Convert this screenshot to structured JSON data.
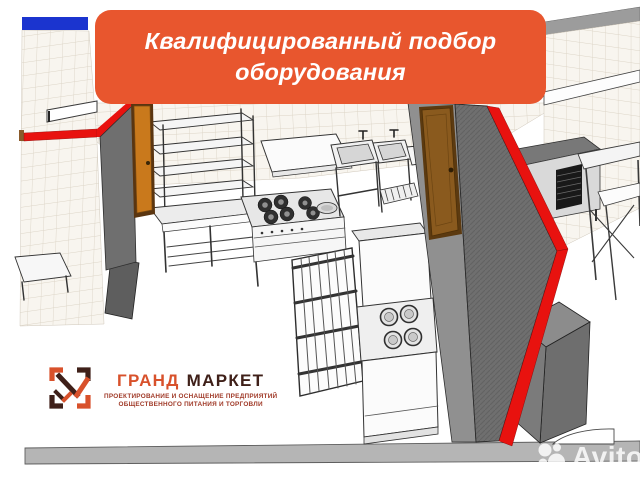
{
  "banner": {
    "line1": "Квалифицированный подбор",
    "line2": "оборудования",
    "bg_color": "#E8562E",
    "text_color": "#FFFFFF"
  },
  "logo": {
    "title_part1": "ГРАНД",
    "title_part2": "МАРКЕТ",
    "subtitle_line1": "ПРОЕКТИРОВАНИЕ И ОСНАЩЕНИЕ ПРЕДПРИЯТИЙ",
    "subtitle_line2": "ОБЩЕСТВЕННОГО ПИТАНИЯ И ТОРГОВЛИ",
    "accent_color": "#D8512B",
    "dark_color": "#3F2019",
    "subtitle_color": "#A03A28"
  },
  "watermark": {
    "text": "Avito"
  },
  "scene": {
    "type": "3d-kitchen-floorplan-render",
    "colors": {
      "accent_red": "#E8120F",
      "wall_gray": "#6F6F6F",
      "tile_background": "#F8F5EF",
      "tile_grid": "#DCD4C6",
      "stripe_blue": "#1B34CF",
      "door_brown": "#8A5A1E",
      "door_orange": "#C9791C",
      "floor_band_gray": "#B5B5B5"
    }
  }
}
